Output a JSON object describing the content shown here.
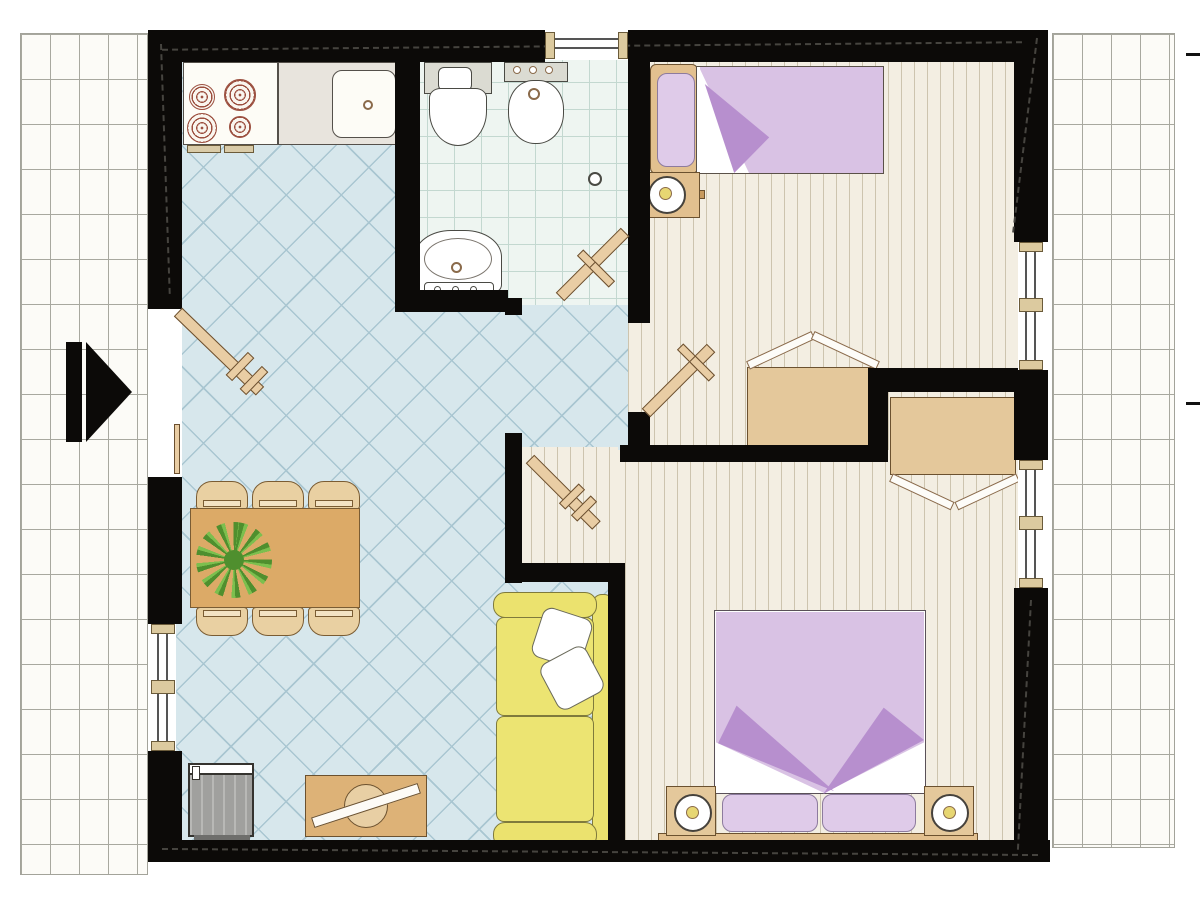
{
  "title": "Apartment floor plan",
  "palette": {
    "wall": "#0c0a08",
    "blue_tile": "#d7e7ec",
    "bath_tile": "#eef5f1",
    "wood_plank": "#f3eee2",
    "terrace_brick": "#fcfbf7",
    "furniture_tan": "#e2c08f",
    "bed_lilac": "#d9c2e4",
    "fold_purple": "#b78fce",
    "sofa_yellow": "#ebe26e",
    "appliance_gray": "#a0a09e",
    "plant_green": "#4f8f2e",
    "burner_red": "#9c5040"
  },
  "terraces": {
    "left": {
      "title": "left terrace (brick paving)"
    },
    "right": {
      "title": "right terrace (brick paving)"
    }
  },
  "entrance": {
    "marker": "black-right-arrow",
    "title": "entrance"
  },
  "rooms": {
    "living": {
      "title": "living-dining room with kitchen",
      "floor": "blue diamond tile"
    },
    "bathroom": {
      "title": "bathroom",
      "floor": "light square tile",
      "fixtures": [
        "toilet",
        "bidet",
        "washbasin",
        "floor-drain"
      ]
    },
    "hallway": {
      "title": "hallway",
      "floor": "blue diamond tile"
    },
    "bedroom1": {
      "title": "bedroom 1 (single)",
      "floor": "wood planks",
      "furniture": [
        "single-bed",
        "pillow",
        "desk",
        "stool",
        "wardrobe"
      ]
    },
    "bedroom2": {
      "title": "bedroom 2 (double)",
      "floor": "wood planks",
      "furniture": [
        "double-bed",
        "pillow-left",
        "pillow-right",
        "nightstand-left",
        "nightstand-right",
        "lamp-left",
        "lamp-right",
        "wardrobe"
      ]
    }
  },
  "kitchen": {
    "stove_burners": 4,
    "units": [
      "stove",
      "counter",
      "sink"
    ]
  },
  "dining": {
    "chairs": 6,
    "table": "rectangular",
    "decor": "plant"
  },
  "lounge": {
    "sofa_cushions": 2,
    "sofa_pillows": 2,
    "items": [
      "yellow-sofa",
      "gray-wood-stove",
      "sideboard"
    ]
  },
  "doors": [
    "entrance-door",
    "bathroom-door",
    "bedroom1-door",
    "bedroom2-door"
  ],
  "windows": [
    "bathroom-top-window",
    "left-wall-window",
    "right-wall-window-upper",
    "right-wall-window-lower"
  ],
  "dimension_ticks": 2
}
